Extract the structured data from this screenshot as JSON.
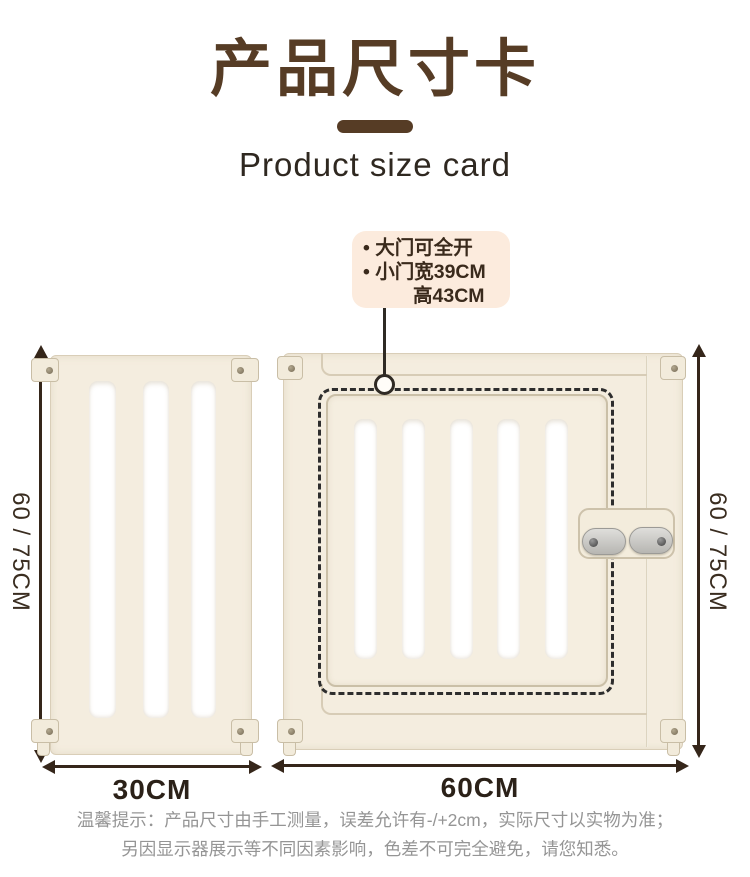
{
  "header": {
    "title": "产品尺寸卡",
    "subtitle": "Product size card"
  },
  "callout": {
    "lines": [
      "• 大门可全开",
      "• 小门宽39CM",
      "高43CM"
    ]
  },
  "diagram": {
    "left_panel": {
      "name": "narrow fence panel with 3 openings",
      "height_label": "60 / 75CM",
      "width_label": "30CM"
    },
    "right_panel": {
      "name": "gate panel with swing door, 5 openings and double latch",
      "height_label": "60 / 75CM",
      "width_label": "60CM"
    }
  },
  "footer": {
    "line1": "温馨提示：产品尺寸由手工测量，误差允许有-/+2cm，实际尺寸以实物为准；",
    "line2": "另因显示器展示等不同因素影响，色差不可完全避免，请您知悉。"
  },
  "colors": {
    "title_brown": "#563c25",
    "subtitle_dark": "#2f2820",
    "panel_cream": "#f4eddf",
    "panel_border": "#d9ceb8",
    "bubble_peach": "#fcebdd",
    "bubble_text": "#3a2a1c",
    "dash_outline": "#2d2d2d",
    "arrow_brown": "#35261a",
    "latch_gray": "#c6c5c1",
    "note_gray": "#959595",
    "background": "#ffffff"
  }
}
